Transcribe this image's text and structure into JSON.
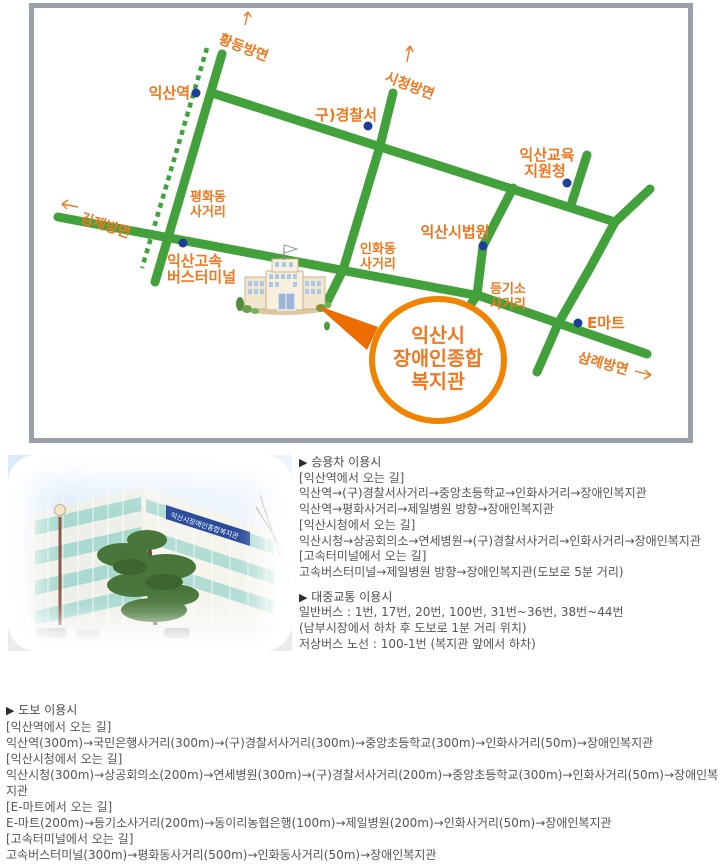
{
  "map": {
    "directions": {
      "hwangdeung": "황등방면",
      "sicheong": "시청방면",
      "gimje": "김제방면",
      "samrye": "삼례방면"
    },
    "pois": {
      "station": "익산역",
      "old_police": "구)경찰서",
      "edu1": "익산교육",
      "edu2": "지원청",
      "court": "익산시법원",
      "emart": "E마트",
      "terminal1": "익산고속",
      "terminal2": "버스터미널"
    },
    "intersections": {
      "pyeonghwa1": "평화동",
      "pyeonghwa2": "사거리",
      "inhwa1": "인화동",
      "inhwa2": "사거리",
      "deunggiso1": "등기소",
      "deunggiso2": "사거리"
    },
    "destination": {
      "line1": "익산시",
      "line2": "장애인종합",
      "line3": "복지관"
    },
    "colors": {
      "road_green": "#43a13c",
      "label_orange": "#f0771e",
      "poi_navy": "#1e3d99",
      "ring_orange": "#f08300",
      "map_border_gray": "#9aa0a8",
      "body_text": "#555555"
    }
  },
  "photo": {
    "building_sign": "익산시장애인종합복지관"
  },
  "sections": {
    "marker": "▶",
    "car": {
      "title": "승용차 이용시",
      "lines": [
        "[익산역에서 오는 길]",
        "익산역→(구)경찰서사거리→중앙초등학교→인화사거리→장애인복지관",
        "익산역→평화사거리→제일병원 방향→장애인복지관",
        "[익산시청에서 오는 길]",
        "익산시청→상공회의소→연세병원→(구)경찰서사거리→인화사거리→장애인복지관",
        "[고속터미널에서 오는 길]",
        "고속버스터미널→제일병원 방향→장애인복지관(도보로 5분 거리)"
      ]
    },
    "transit": {
      "title": "대중교통 이용시",
      "lines": [
        "일반버스 : 1번, 17번, 20번, 100번, 31번~36번, 38번~44번",
        "(남부시장에서 하차 후 도보로 1분 거리 위치)",
        "저상버스 노선 : 100-1번 (복지관 앞에서 하차)"
      ]
    },
    "walk": {
      "title": "도보 이용시",
      "lines": [
        "[익산역에서 오는 길]",
        "익산역(300m)→국민은행사거리(300m)→(구)경찰서사거리(300m)→중앙초등학교(300m)→인화사거리(50m)→장애인복지관",
        "[익산시청에서 오는 길]",
        "익산시청(300m)→상공회의소(200m)→연세병원(300m)→(구)경찰서사거리(200m)→중앙초등학교(300m)→인화사거리(50m)→장애인복지관",
        "[E-마트에서 오는 길]",
        "E-마트(200m)→등기소사거리(200m)→동이리농협은행(100m)→제일병원(200m)→인화사거리(50m)→장애인복지관",
        "[고속터미널에서 오는 길]",
        "고속버스터미널(300m)→평화동사거리(500m)→인화동사거리(50m)→장애인복지관"
      ]
    }
  }
}
